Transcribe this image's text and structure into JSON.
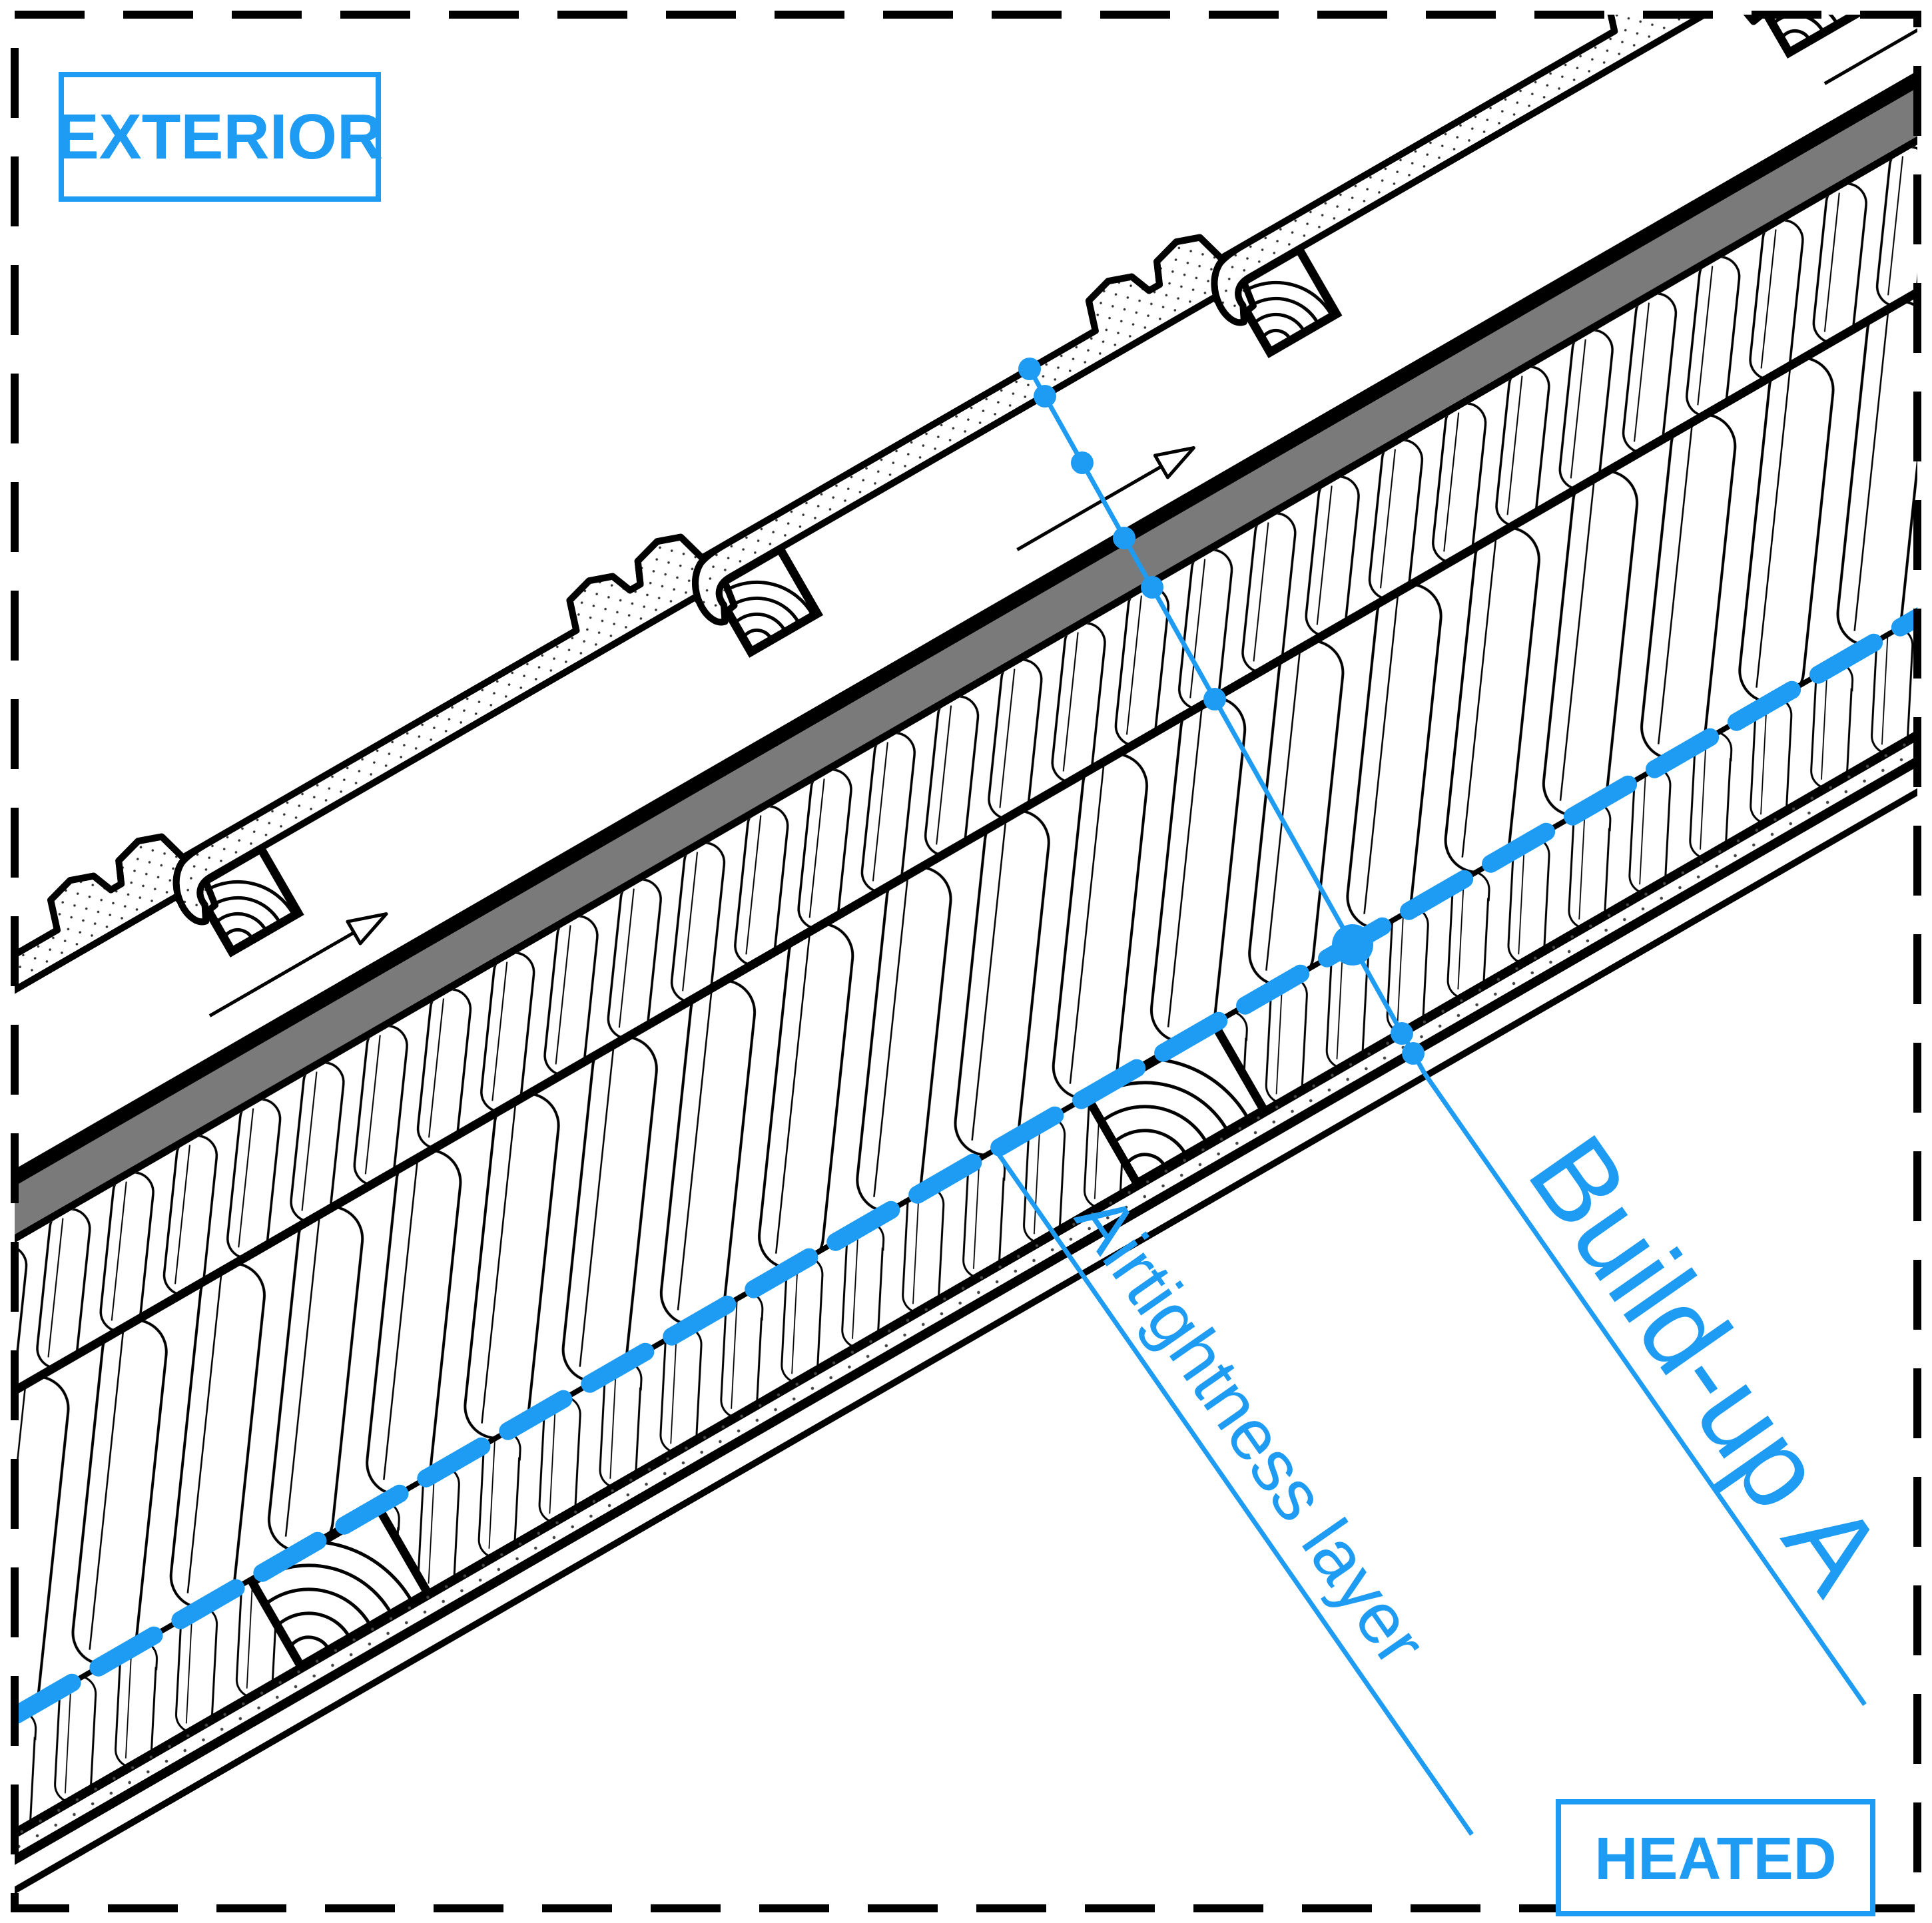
{
  "diagram": {
    "title_implied": "Pitched roof build-up detail section",
    "slope_degrees": 30,
    "zones": {
      "exterior_label": "EXTERIOR",
      "heated_label": "HEATED"
    },
    "annotations": {
      "buildup_label": "Build-up A",
      "airtightness_label": "Airtightness layer",
      "buildup_line_dot_count": 8,
      "buildup_line_big_dot_count": 1,
      "ventilation_arrow_count": 3
    },
    "layers": [
      {
        "id": "interlocking-roof-tiles",
        "texture": "stipple-dots"
      },
      {
        "id": "tile-battens-wood",
        "count_visible": 4
      },
      {
        "id": "ventilated-air-gap",
        "symbol": "airflow-arrows"
      },
      {
        "id": "sarking-board",
        "fill": "#7A7A7A"
      },
      {
        "id": "insulation-over-rafter",
        "texture": "mineral-wool-capsules-small"
      },
      {
        "id": "insulation-main",
        "texture": "mineral-wool-capsules-large"
      },
      {
        "id": "airtightness-layer",
        "style": "blue-dashed-line"
      },
      {
        "id": "service-layer-insulation-with-battens",
        "batten_count_visible": 2
      },
      {
        "id": "lining-boards",
        "texture": "stipple-dots"
      }
    ],
    "colors": {
      "accent_blue": "#1E9BF3",
      "sarking_gray": "#7A7A7A",
      "line_black": "#000000",
      "background": "#FFFFFF"
    }
  }
}
